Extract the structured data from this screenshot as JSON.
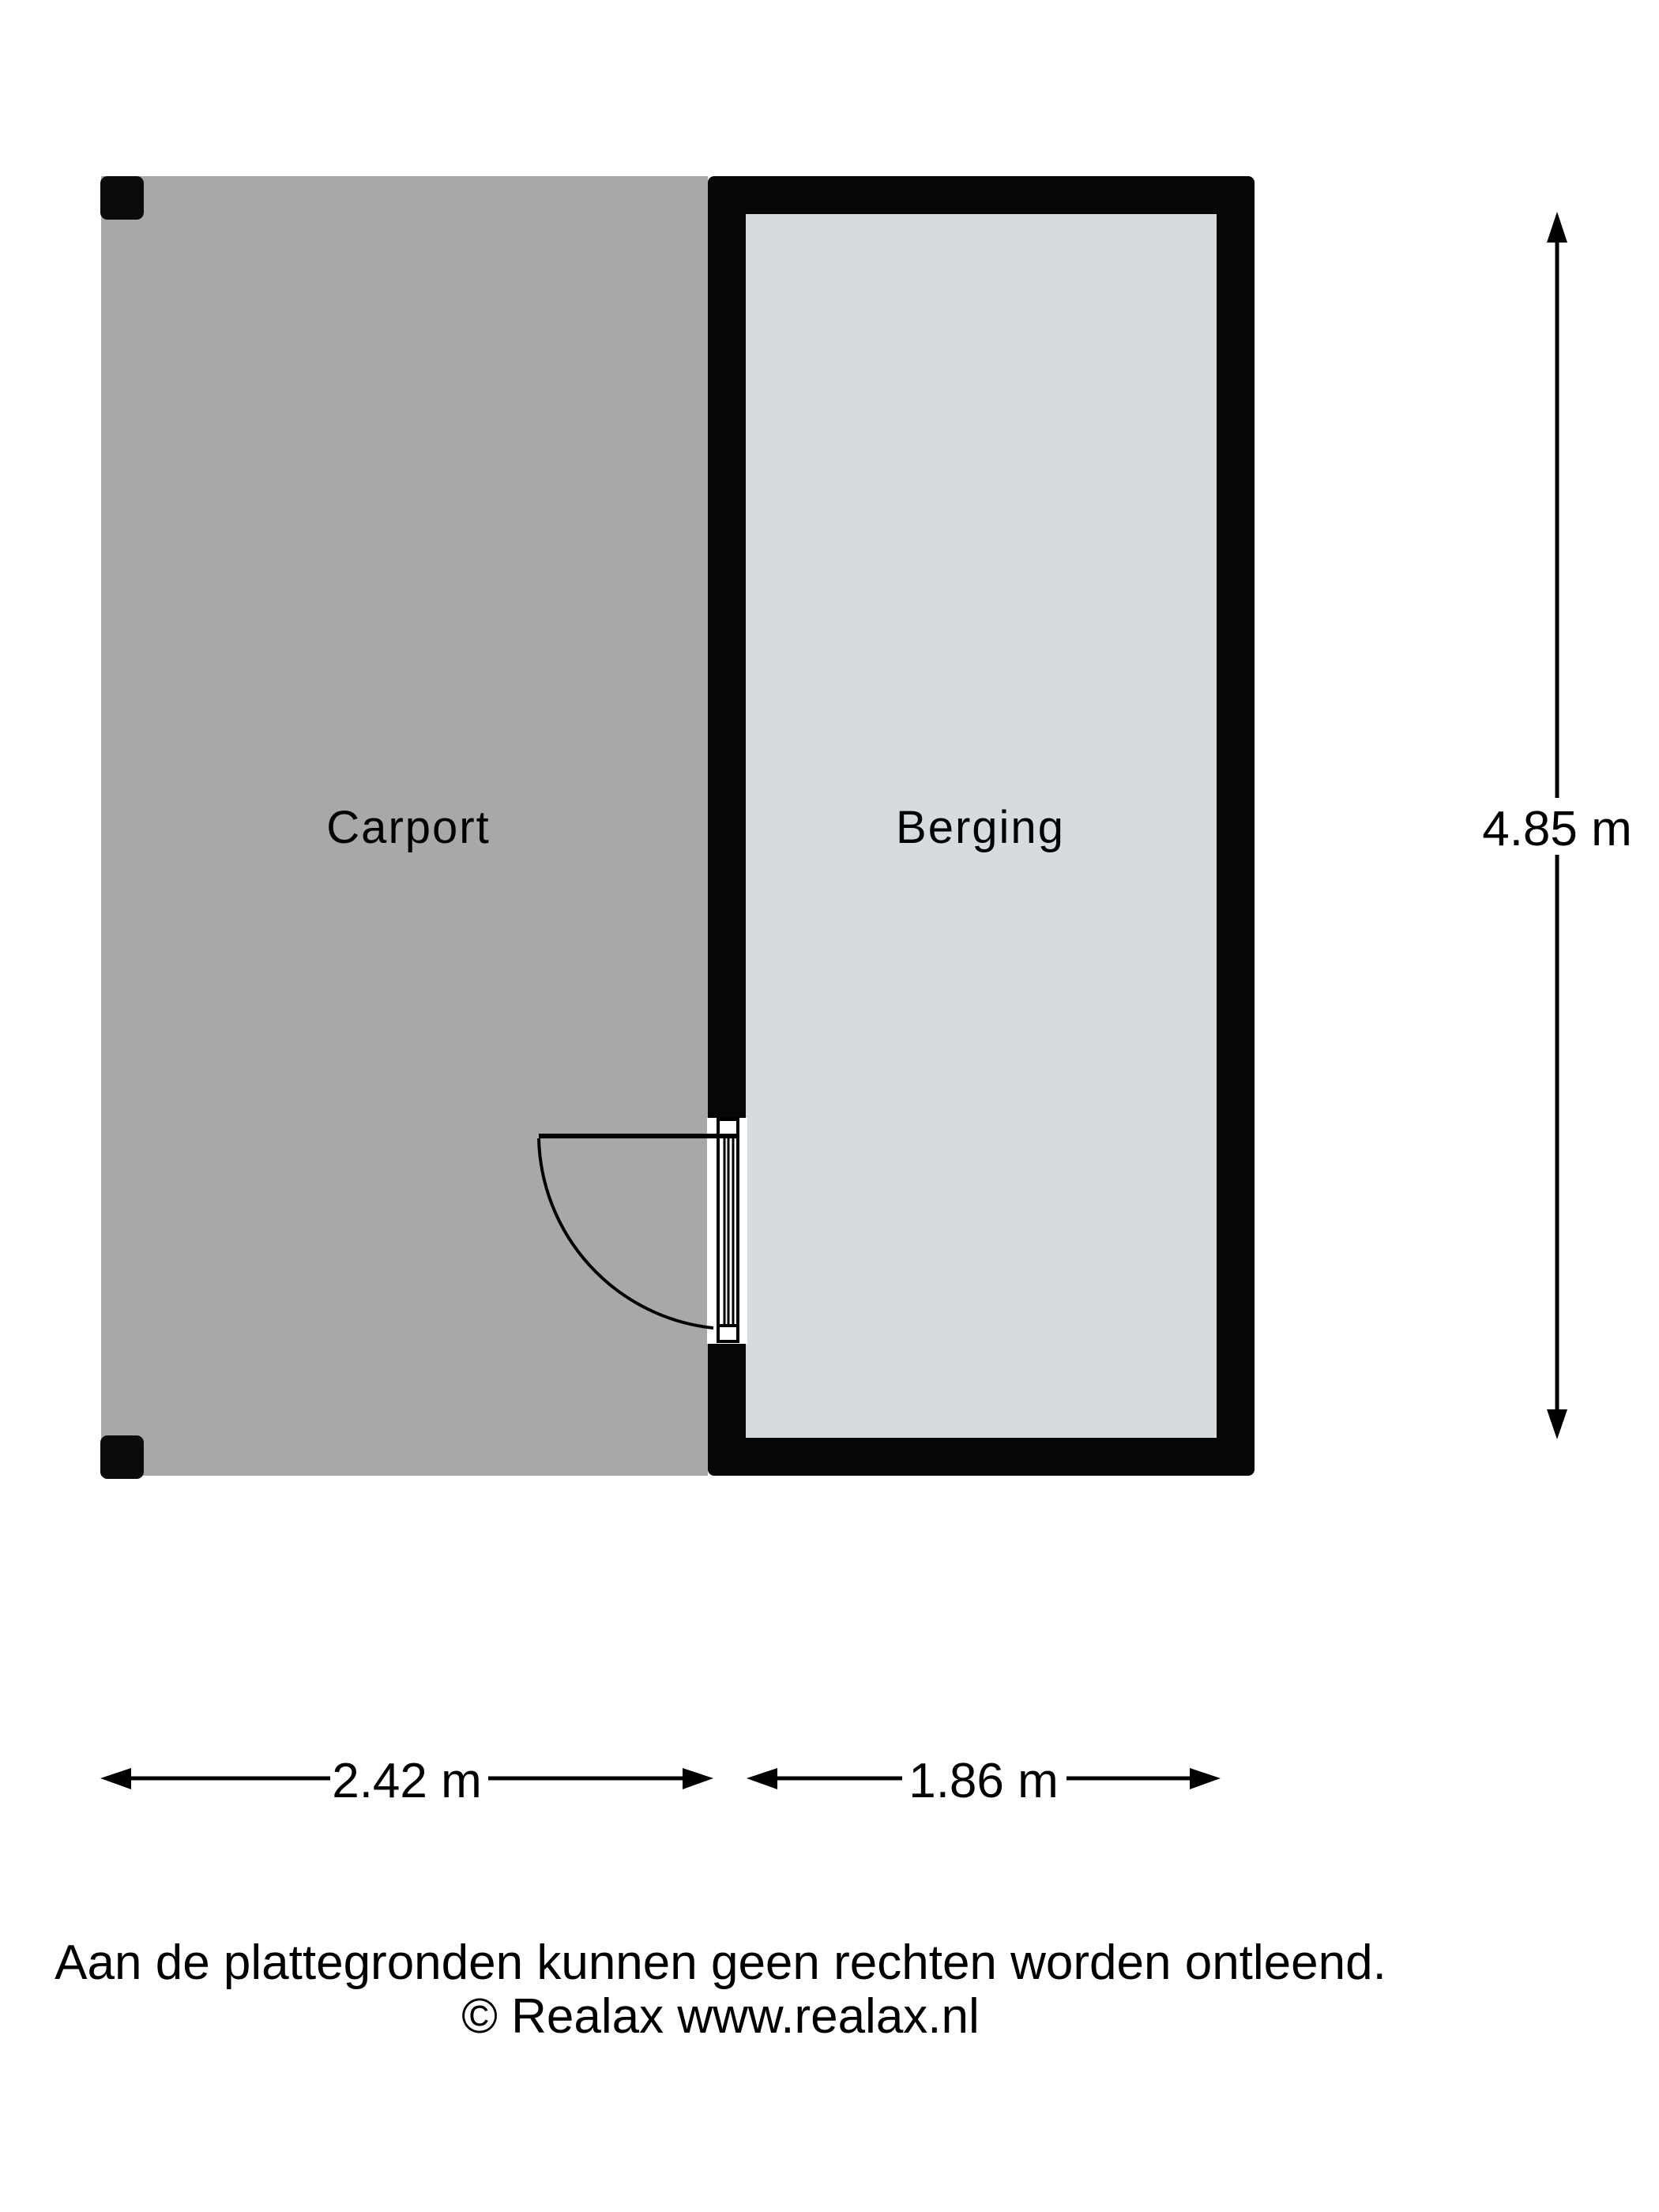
{
  "plan": {
    "rooms": {
      "carport": {
        "label": "Carport"
      },
      "berging": {
        "label": "Berging"
      }
    },
    "dimensions": {
      "height_label": "4.85 m",
      "carport_width_label": "2.42 m",
      "berging_width_label": "1.86 m"
    },
    "footer": {
      "disclaimer": "Aan de plattegronden kunnen geen rechten worden ontleend.",
      "copyright": "© Realax www.realax.nl"
    },
    "colors": {
      "background": "#ffffff",
      "carport_floor": "#a8a8a8",
      "berging_floor": "#d7dbdf",
      "wall": "#060606",
      "post": "#0b0b0b"
    }
  }
}
